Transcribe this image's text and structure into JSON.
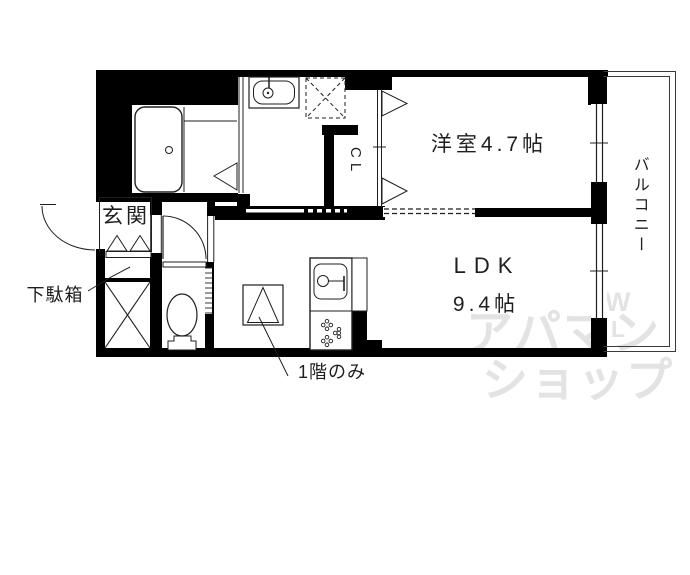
{
  "labels": {
    "entrance": "玄関",
    "shoe_cabinet": "下駄箱",
    "closet": "CL",
    "western_room": "洋室4.7帖",
    "ldk": "LDK",
    "ldk_size": "9.4帖",
    "balcony": "バルコニー",
    "first_floor_note": "1階のみ"
  },
  "watermark": {
    "line1": "アパマン",
    "line2": "ショップ",
    "w_mark": "W",
    "l_mark": "L"
  },
  "fixtures": [
    "bathtub",
    "washbasin",
    "washing-machine-space",
    "toilet",
    "kitchen-sink",
    "stove-burners",
    "closet-folding-door",
    "entrance-door",
    "hall-door",
    "bathroom-door",
    "window",
    "shoe-cabinet",
    "storage-x-box",
    "first-floor-only-symbol"
  ],
  "colors": {
    "walls": "#000000",
    "lines": "#1f1f1f",
    "label_text": "#1f1f1f",
    "watermark": "#e3e3e3",
    "background": "#ffffff"
  }
}
